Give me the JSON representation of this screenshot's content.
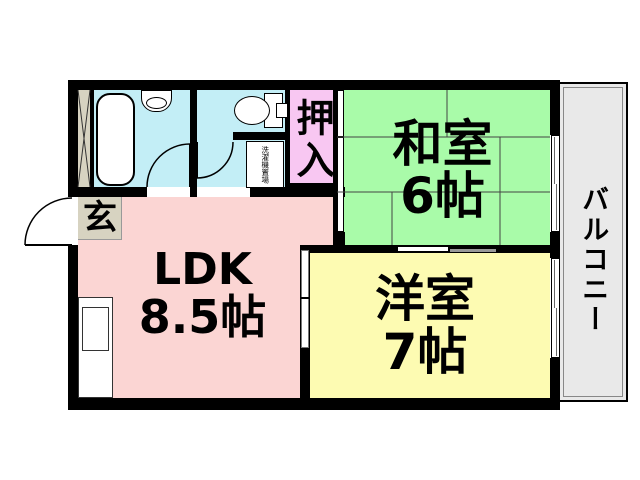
{
  "floorplan": {
    "rooms": {
      "genkan": {
        "label": "玄"
      },
      "ldk": {
        "label": "LDK",
        "size": "8.5帖"
      },
      "washitsu": {
        "label": "和室",
        "size": "6帖"
      },
      "youshitsu": {
        "label": "洋室",
        "size": "7帖"
      },
      "oshiire": {
        "label": "押入"
      },
      "balcony": {
        "label": "バルコニー"
      },
      "laundry": {
        "label": "洗濯機置場"
      }
    },
    "colors": {
      "wall": "#000000",
      "ldk": "#fbd5d3",
      "washitsu": "#a9fba9",
      "youshitsu": "#fdfbb2",
      "oshiire": "#f8c7f2",
      "wet_area": "#c3eef6",
      "genkan": "#d7d3c1",
      "balcony": "#e9e9e9"
    }
  }
}
